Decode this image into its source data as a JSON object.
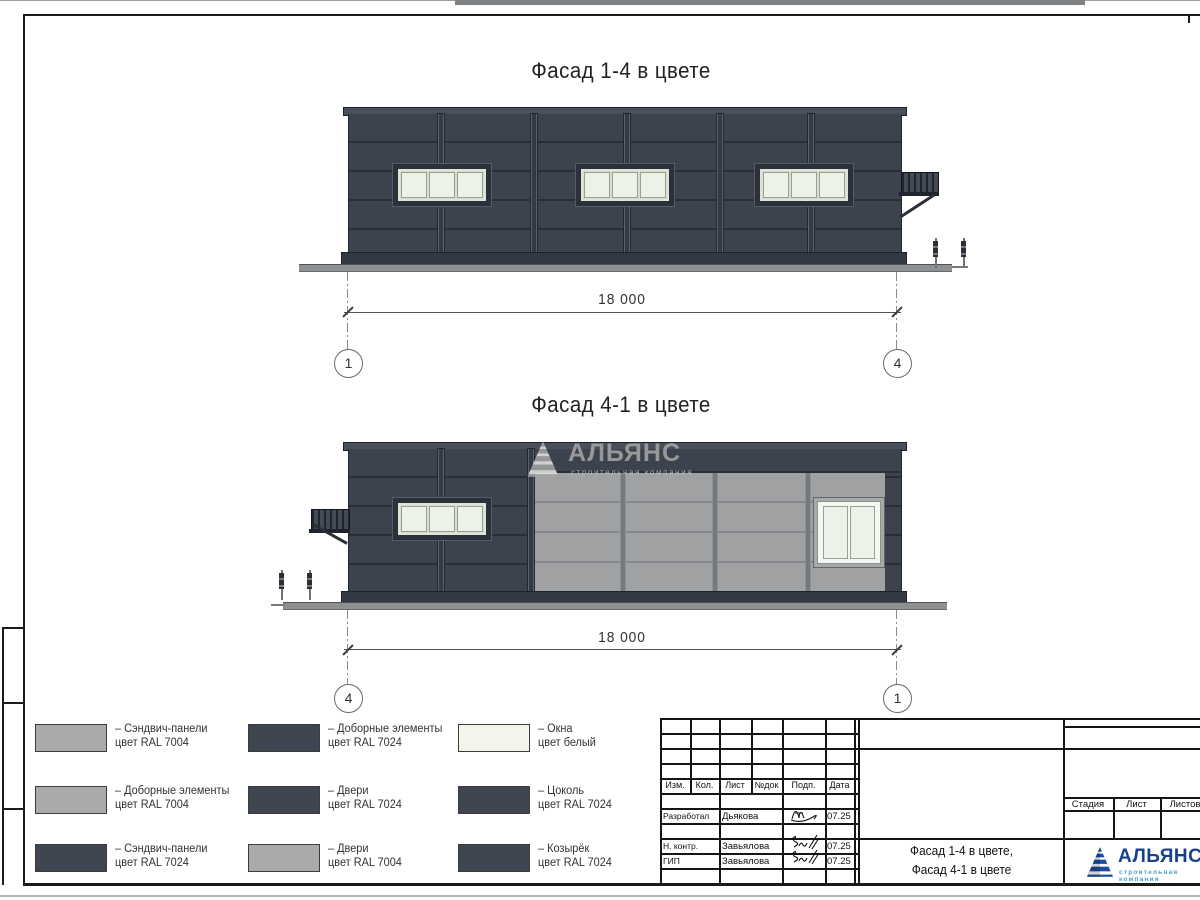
{
  "facade1": {
    "title": "Фасад 1-4 в цвете",
    "dim": "18 000",
    "axis_left": "1",
    "axis_right": "4"
  },
  "facade2": {
    "title": "Фасад 4-1 в цвете",
    "dim": "18 000",
    "axis_left": "4",
    "axis_right": "1"
  },
  "watermark": {
    "name": "АЛЬЯНС",
    "subtitle": "строительная компания"
  },
  "legend": {
    "items": [
      {
        "l1": "– Сэндвич-панели",
        "l2": "цвет RAL 7004",
        "color": "#a9abaa"
      },
      {
        "l1": "– Доборные элементы",
        "l2": "цвет RAL 7024",
        "color": "#3f4551"
      },
      {
        "l1": "– Окна",
        "l2": "цвет белый",
        "color": "#f3f5eb"
      },
      {
        "l1": "– Доборные элементы",
        "l2": "цвет RAL 7004",
        "color": "#a9abaa"
      },
      {
        "l1": "– Двери",
        "l2": "цвет RAL 7024",
        "color": "#3f4551"
      },
      {
        "l1": "– Цоколь",
        "l2": "цвет RAL 7024",
        "color": "#3f4551"
      },
      {
        "l1": "– Сэндвич-панели",
        "l2": "цвет RAL 7024",
        "color": "#3f4551"
      },
      {
        "l1": "– Двери",
        "l2": "цвет RAL 7004",
        "color": "#a9abaa"
      },
      {
        "l1": "– Козырёк",
        "l2": "цвет RAL 7024",
        "color": "#3f4551"
      }
    ]
  },
  "title_block": {
    "headers": [
      "Изм.",
      "Кол.",
      "Лист",
      "№док",
      "Подп.",
      "Дата"
    ],
    "rows": [
      {
        "role": "Разработал",
        "name": "Дьякова",
        "date": "07.25"
      },
      {
        "role": "Н. контр.",
        "name": "Завьялова",
        "date": "07.25"
      },
      {
        "role": "ГИП",
        "name": "Завьялова",
        "date": "07.25"
      }
    ],
    "doc_title1": "Фасад 1-4 в цвете,",
    "doc_title2": "Фасад 4-1 в цвете",
    "stage_headers": [
      "Стадия",
      "Лист",
      "Листов"
    ],
    "logo_name": "АЛЬЯНС",
    "logo_subtitle": "строительная компания"
  },
  "colors": {
    "ral7004_light_gray": "#a9abaa",
    "ral7024_dark_gray": "#3f4551",
    "windows_white": "#f3f5eb",
    "facade_dark_panel": "#3d434e",
    "facade_light_panel": "#9fa1a3",
    "logo_blue": "#17418f",
    "logo_subtitle_blue": "#49a0d5"
  }
}
